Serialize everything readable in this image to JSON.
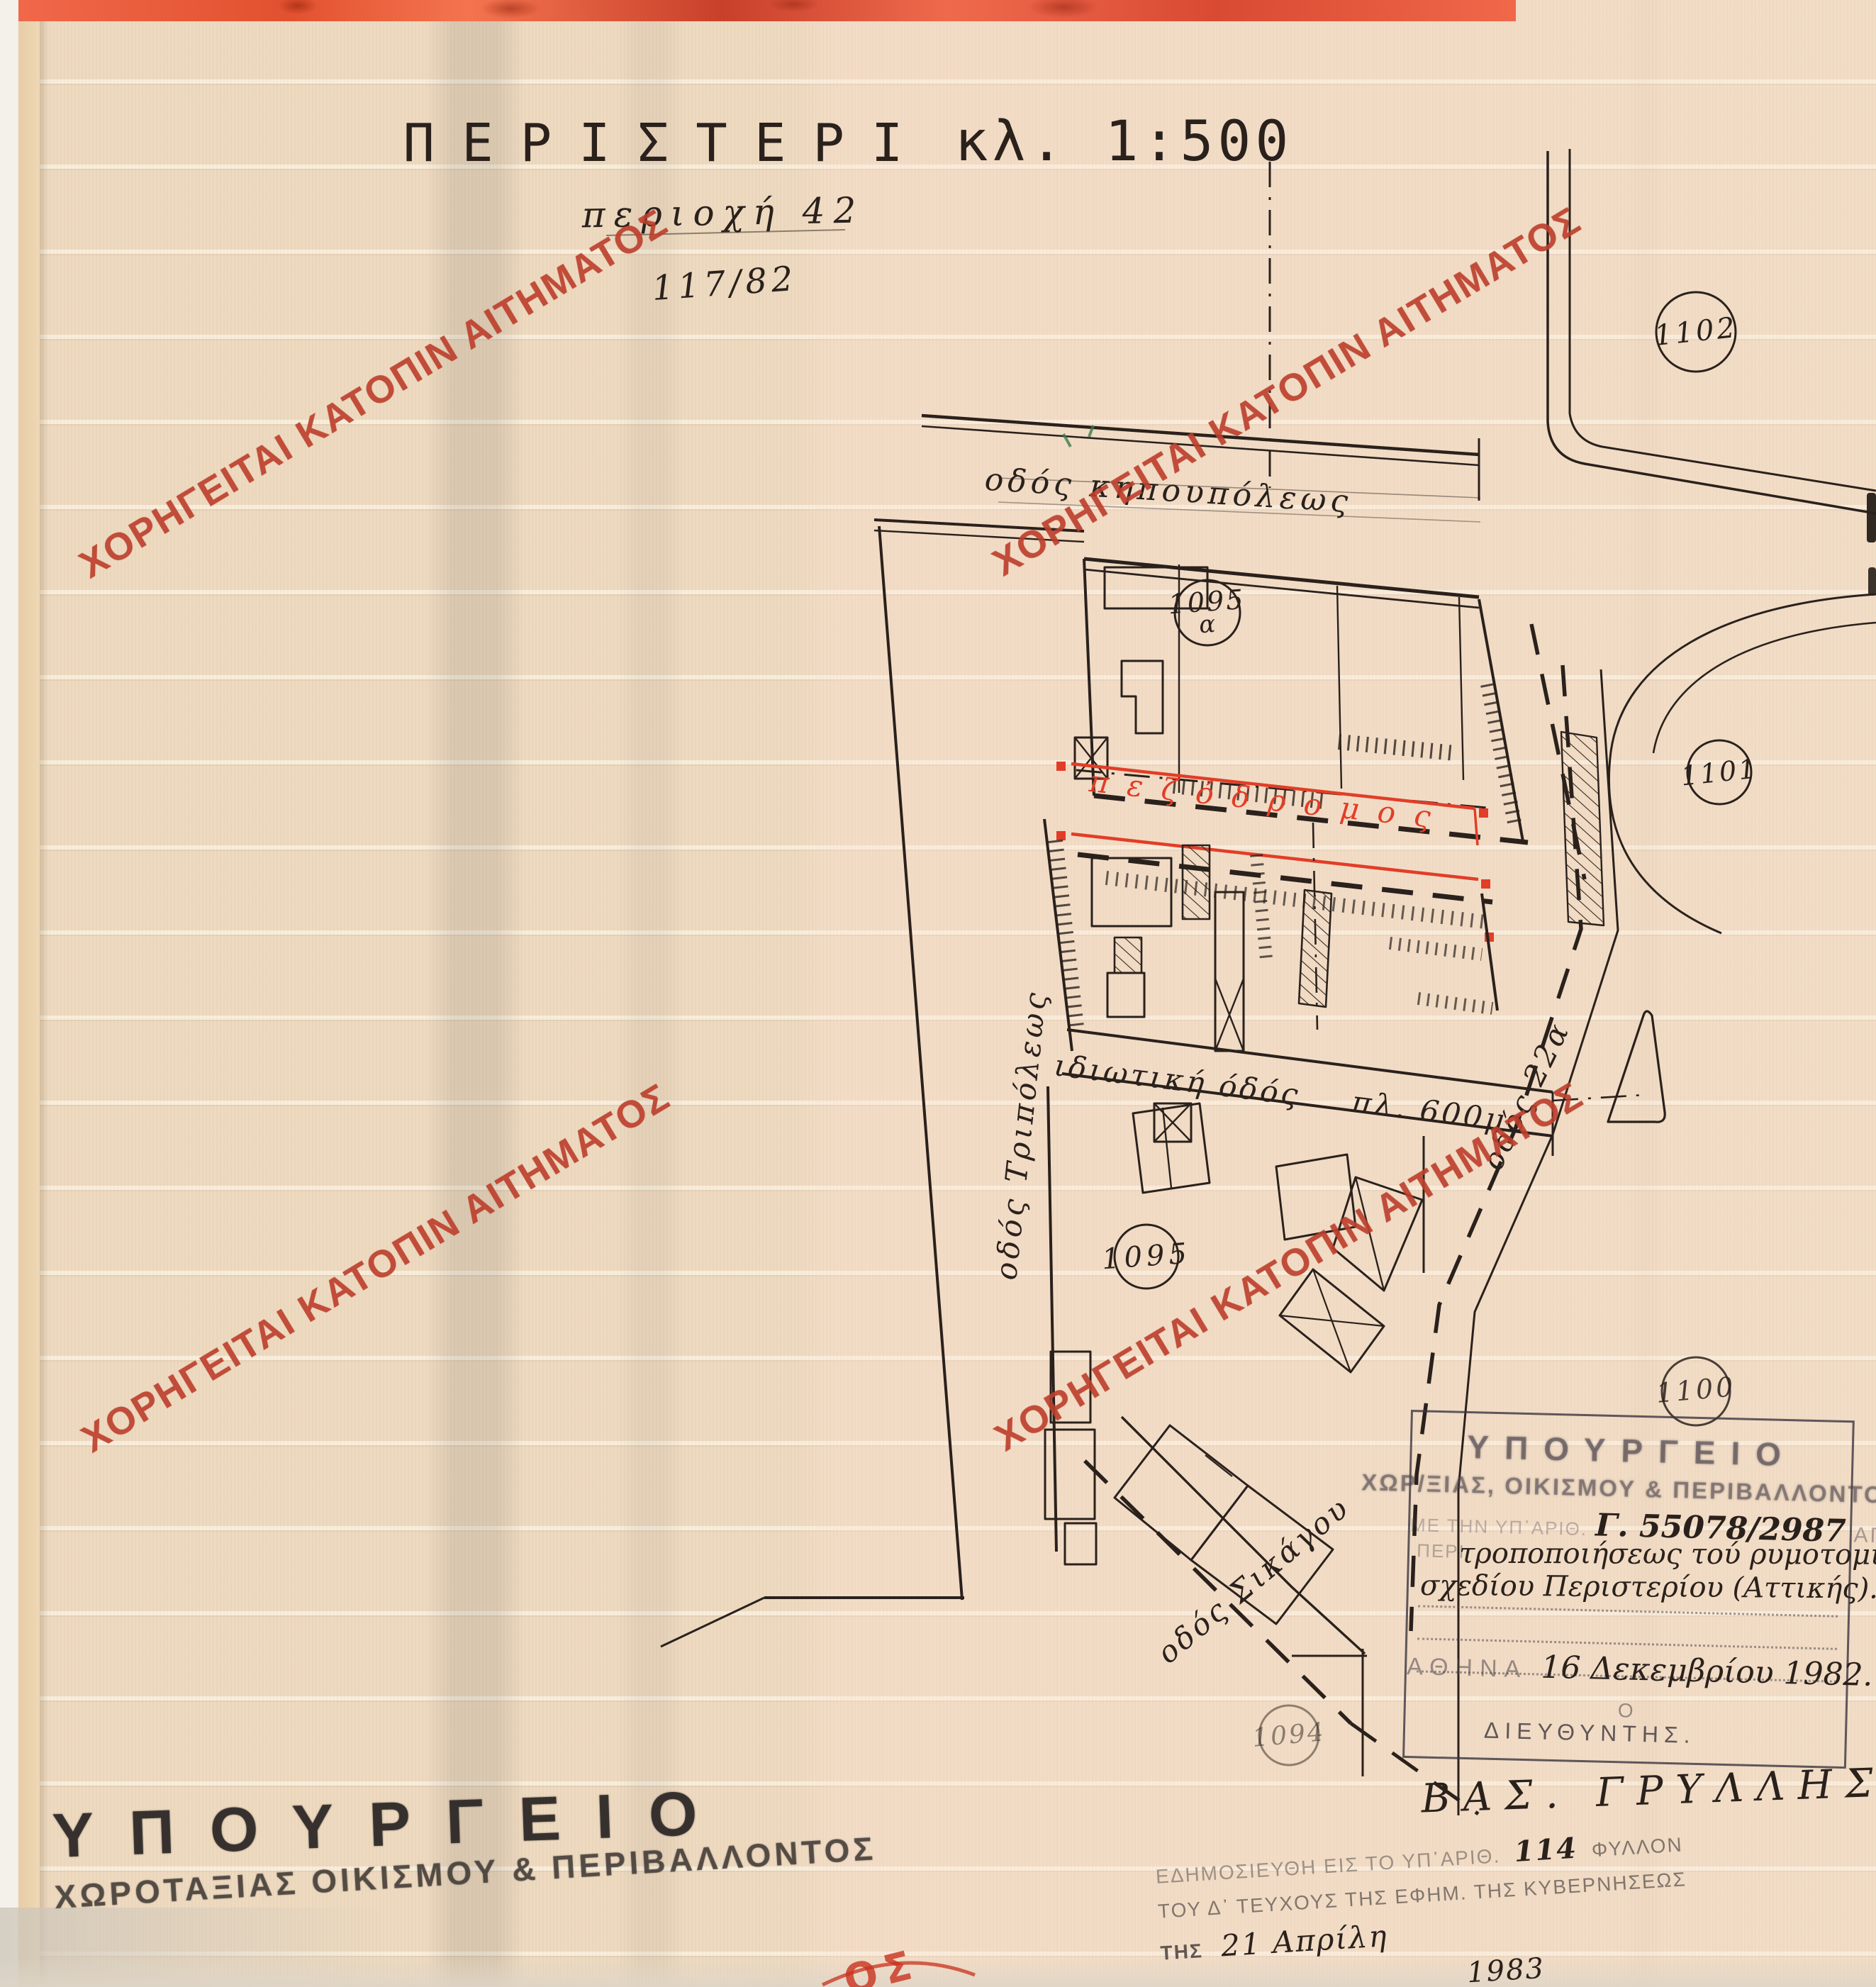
{
  "page": {
    "watermark_text": "ΧΟΡΗΓΕΙΤΑΙ ΚΑΤΟΠΙΝ ΑΙΤΗΜΑΤΟΣ",
    "colors": {
      "paper": "#eedac0",
      "ink": "#2a211c",
      "plan_red": "#e23d27",
      "watermark_red": "#bc3e2c",
      "stamp_ink": "#4d464b",
      "header_band": "#ef6a4d"
    }
  },
  "title_block": {
    "city": "ΠΕΡΙΣΤΕΡΙ",
    "scale": "κλ. 1:500",
    "area_note": "περιοχή 42",
    "file_note": "117/82"
  },
  "map": {
    "street_top": "οδός κηπουπόλεως",
    "street_left": "οδός Τριπόλεως",
    "street_private_name": "ιδιωτική όδός",
    "street_private_width": "πλ. 600μ.",
    "street_right": "οδός 22α",
    "street_diagonal": "οδός Σικάγου",
    "pedestrian_way": "πεζόδρομος",
    "blocks": [
      {
        "number": "1102"
      },
      {
        "number": "1101"
      },
      {
        "number": "1095",
        "suffix": "α"
      },
      {
        "number": "1095"
      },
      {
        "number": "1100"
      },
      {
        "number": "1094"
      }
    ]
  },
  "approval_stamp": {
    "line1": "ΥΠΟΥΡΓΕΙΟ",
    "line2": "ΧΩΡ/ΞΙΑΣ, ΟΙΚΙΣΜΟΥ & ΠΕΡΙΒΑΛΛΟΝΤΟΣ",
    "ref_faded_left": "ΠΕΡΙ",
    "ref_faded": "ΜΕ ΤΗΝ ΥΠ᾽ΑΡΙΘ.",
    "decision_number": "Γ. 55078/2987",
    "ref_faded_right": "ΑΠΟΦΑΣΗ",
    "subject_line1": "τροποποιήσεως τού ρυμοτομικού",
    "subject_line2": "σχεδίου Περιστερίου (Αττικής).",
    "city": "ΑΘΗΝΑ",
    "date": "16 Δεκεμβρίου 1982.",
    "article": "Ο",
    "director": "ΔΙΕΥΘΥΝΤΗΣ.",
    "signature": "ΒΑΣ. ΓΡΥΛΛΗΣ."
  },
  "ministry_stamp": {
    "line1": "ΥΠΟΥΡΓΕΙΟ",
    "line2": "ΧΩΡΟΤΑΞΙΑΣ ΟΙΚΙΣΜΟΥ & ΠΕΡΙΒΑΛΛΟΝΤΟΣ"
  },
  "publication_note": {
    "line1_prefix": "ΕΔΗΜΟΣΙΕΥΘΗ ΕΙΣ ΤΟ ΥΠ᾽ΑΡΙΘ.",
    "sheet_no": "114",
    "line1_suffix": "ΦΥΛΛΟΝ",
    "line2": "ΤΟΥ Δ᾽ ΤΕΥΧΟΥΣ ΤΗΣ ΕΦΗΜ. ΤΗΣ ΚΥΒΕΡΝΗΣΕΩΣ",
    "line3_prefix": "ΤΗΣ",
    "line3_date": "21 Απρίλη",
    "year": "1983"
  },
  "bottom_red_fragment": "ΟΣ"
}
